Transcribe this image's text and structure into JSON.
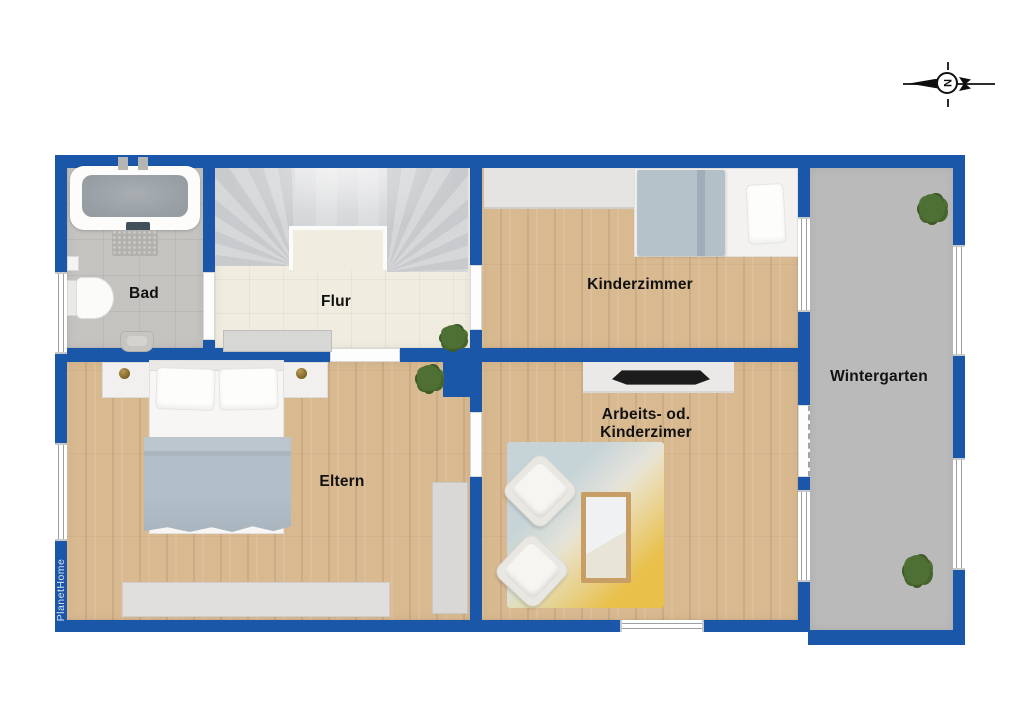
{
  "watermark": "PlanetHome",
  "compass": {
    "letter": "N"
  },
  "rooms": {
    "bad": {
      "label": "Bad"
    },
    "flur": {
      "label": "Flur"
    },
    "kinderzimmer": {
      "label": "Kinderzimmer"
    },
    "wintergarten": {
      "label": "Wintergarten"
    },
    "eltern": {
      "label": "Eltern"
    },
    "arbeitszimmer": {
      "label_line1": "Arbeits- od.",
      "label_line2": "Kinderzimer"
    }
  },
  "colors": {
    "wall": "#1a57a8",
    "tile_gray": "#c5c3c0",
    "tile_cream": "#f0ecdf",
    "wood": "#d9b990",
    "winter_floor": "#bbbaba",
    "stairs": "#d0d1d4",
    "blanket": "#adbac3",
    "rug_base": "#eae6da",
    "rug_blue": "#c6d4d7",
    "rug_yellow": "#e9c04a",
    "plant": "#4f7034",
    "label": "#111111",
    "watermark": "#d7e1f2"
  }
}
